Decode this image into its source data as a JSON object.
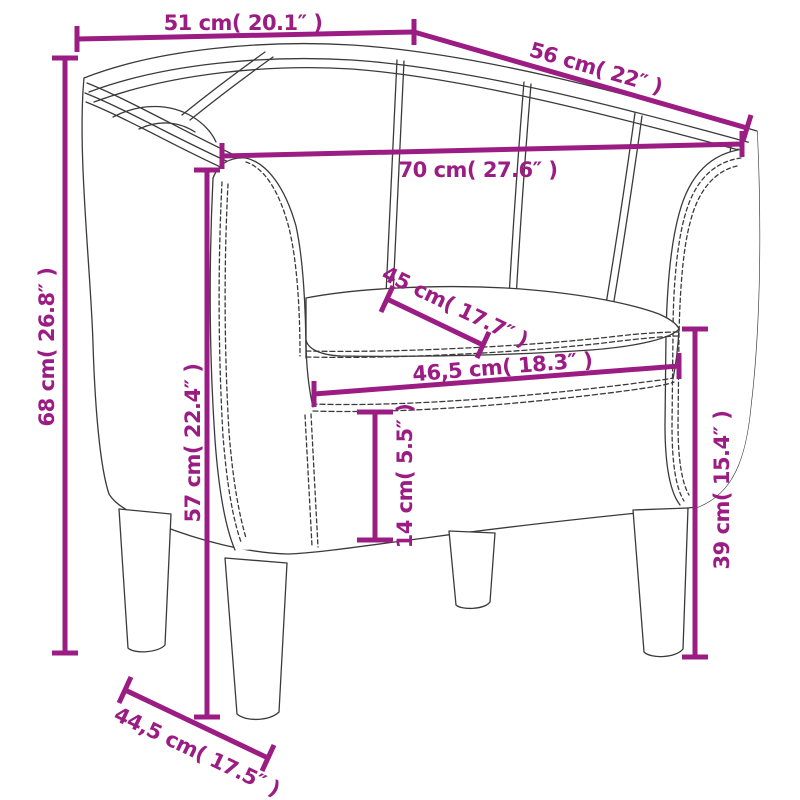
{
  "diagram": {
    "kind": "product-dimension-diagram",
    "subject": "tub-club-chair-line-drawing",
    "colors": {
      "accent": "#9B1C82",
      "line": "#3a3a3a",
      "background": "#ffffff"
    },
    "dimensions": [
      {
        "id": "top-width",
        "label": "51 cm( 20.1″ )",
        "cm": "51",
        "inches": "20.1"
      },
      {
        "id": "top-depth",
        "label": "56 cm( 22″ )",
        "cm": "56",
        "inches": "22"
      },
      {
        "id": "back-inner-width",
        "label": "70 cm( 27.6″ )",
        "cm": "70",
        "inches": "27.6"
      },
      {
        "id": "seat-depth",
        "label": "45 cm( 17.7″ )",
        "cm": "45",
        "inches": "17.7"
      },
      {
        "id": "seat-width",
        "label": "46,5 cm( 18.3″ )",
        "cm": "46,5",
        "inches": "18.3"
      },
      {
        "id": "total-height",
        "label": "68 cm( 26.8″ )",
        "cm": "68",
        "inches": "26.8"
      },
      {
        "id": "armrest-height",
        "label": "57 cm( 22.4″ )",
        "cm": "57",
        "inches": "22.4"
      },
      {
        "id": "cushion-to-base",
        "label": "14 cm( 5.5″ )",
        "cm": "14",
        "inches": "5.5"
      },
      {
        "id": "seat-height",
        "label": "39 cm( 15.4″ )",
        "cm": "39",
        "inches": "15.4"
      },
      {
        "id": "base-depth",
        "label": "44,5 cm( 17.5″ )",
        "cm": "44,5",
        "inches": "17.5"
      }
    ]
  }
}
